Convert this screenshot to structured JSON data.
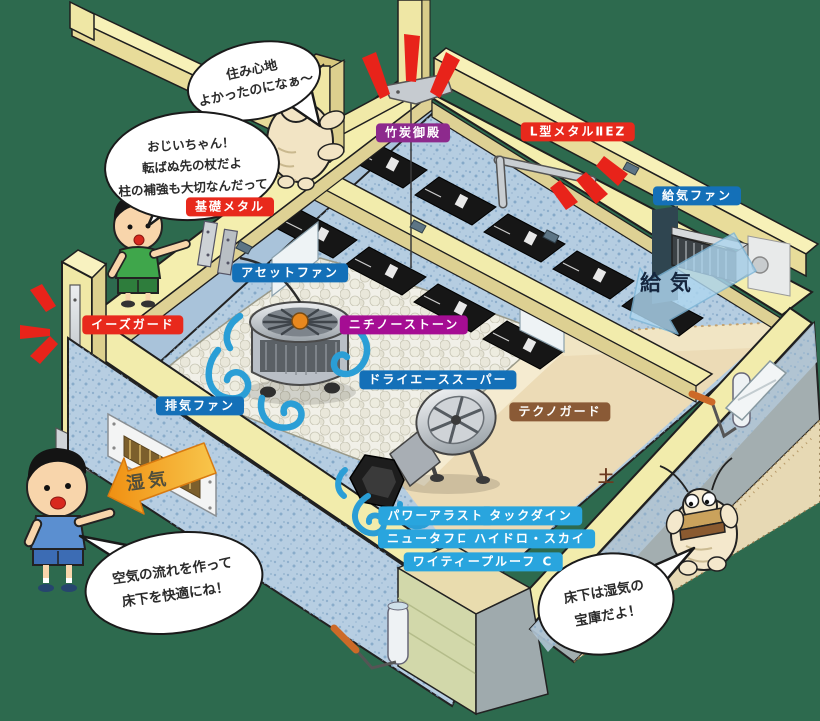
{
  "background_color": "#2d6a4e",
  "product_labels": [
    {
      "id": "takesumi-goten",
      "text": "竹炭御殿",
      "color": "#8d2a8d"
    },
    {
      "id": "l-gata-metal-2ez",
      "text": "L型メタルⅡEZ",
      "color": "#e8291c"
    },
    {
      "id": "kiso-metal",
      "text": "基礎メタル",
      "color": "#e8291c"
    },
    {
      "id": "kyuki-fan",
      "text": "給気ファン",
      "color": "#1470b8"
    },
    {
      "id": "asset-fan",
      "text": "アセットファン",
      "color": "#1470b8"
    },
    {
      "id": "nichino-stone",
      "text": "ニチノーストーン",
      "color": "#a50d93"
    },
    {
      "id": "ease-guard",
      "text": "イーズガード",
      "color": "#e8291c"
    },
    {
      "id": "dry-ace-super",
      "text": "ドライエーススーパー",
      "color": "#1470b8"
    },
    {
      "id": "haiki-fan",
      "text": "排気ファン",
      "color": "#1470b8"
    },
    {
      "id": "techno-guard",
      "text": "テクノガード",
      "color": "#8a5a36"
    },
    {
      "id": "power-arast",
      "text": "パワーアラスト",
      "color": "#29a5de"
    },
    {
      "id": "tack-dyne",
      "text": "タックダイン",
      "color": "#29a5de"
    },
    {
      "id": "new-taflon",
      "text": "ニュータフロン",
      "color": "#29a5de"
    },
    {
      "id": "hydro-sky",
      "text": "ハイドロ・スカイ",
      "color": "#29a5de"
    },
    {
      "id": "ytp-proof-c",
      "text": "ワイティープルーフ C",
      "color": "#29a5de"
    }
  ],
  "speech_bubbles": [
    {
      "speaker": "termite-on-post",
      "text": "住み心地\nよかったのになぁ〜"
    },
    {
      "speaker": "boy-green",
      "text": "おじいちゃん！\n転ばぬ先の杖だよ\n柱の補強も大切なんだって"
    },
    {
      "speaker": "boy-blue",
      "text": "空気の流れを作って\n床下を快適にね！"
    },
    {
      "speaker": "termite-underfloor",
      "text": "床下は湿気の\n宝庫だよ！"
    }
  ],
  "annotations": {
    "air_supply": "給気",
    "moisture": "湿気",
    "soil": "土"
  },
  "palette": {
    "wood": "#f4eeae",
    "concrete": "#b5cde1",
    "pebbles": "#f1f0e8",
    "soil": "#ecdbb6",
    "charcoal_pack": "#161616",
    "airflow": "#2a9ed6",
    "emphasis_marks": "#e8231a",
    "moisture_arrow": "#f3a722",
    "supply_arrow": "#aed6ef"
  }
}
